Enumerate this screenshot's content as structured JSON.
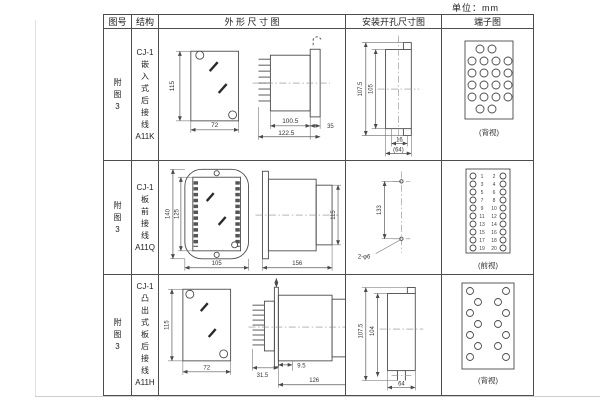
{
  "unit_label": "单位：mm",
  "table": {
    "headers": {
      "fig_no": "图号",
      "structure": "结构",
      "outline": "外 形 尺 寸 图",
      "mounting": "安装开孔尺寸图",
      "terminal": "端子图"
    },
    "rows": [
      {
        "fig_no": "附\n图\n3",
        "structure": "CJ-1\n嵌\n入\n式\n后\n接\n线\nA11K",
        "outline": {
          "front_height": "115",
          "front_width": "72",
          "body_depth": "100.5",
          "total_depth": "122.5",
          "flange": "35"
        },
        "mounting": {
          "outer_height": "107.5",
          "inner_height": "105",
          "slot_width": "16",
          "overall_width": "(64)"
        },
        "terminal_caption": "(背视)"
      },
      {
        "fig_no": "附\n图\n3",
        "structure": "CJ-1\n板\n前\n接\n线\nA11Q",
        "outline": {
          "front_height": "140",
          "inner_height": "125",
          "front_width": "105",
          "body_length": "156",
          "side_height": "115"
        },
        "mounting": {
          "hole_spacing": "133",
          "hole_label": "2-φ6"
        },
        "terminal_caption": "(前视)",
        "terminal_numbers_left": [
          "1",
          "3",
          "5",
          "7",
          "9",
          "11",
          "13",
          "15",
          "17",
          "19"
        ],
        "terminal_numbers_right": [
          "2",
          "4",
          "6",
          "8",
          "10",
          "12",
          "14",
          "16",
          "18",
          "20"
        ]
      },
      {
        "fig_no": "附\n图\n3",
        "structure": "CJ-1\n凸\n出\n式\n板\n后\n接\n线\nA11H",
        "outline": {
          "front_height": "115",
          "front_width": "72",
          "pin_depth": "31.5",
          "gap": "9.5",
          "body_length": "126"
        },
        "mounting": {
          "outer_height": "107.5",
          "inner_height": "104",
          "width": "64"
        },
        "terminal_caption": "(背视)"
      }
    ]
  }
}
